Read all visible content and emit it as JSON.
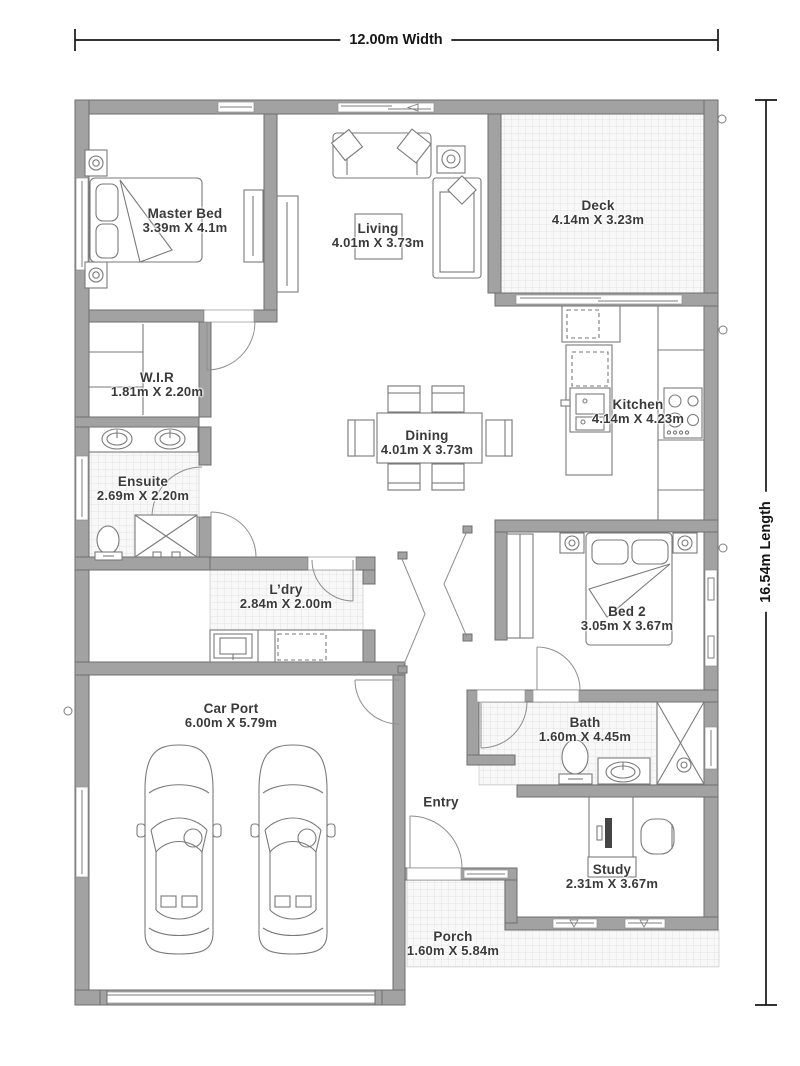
{
  "plan": {
    "width_label": "12.00m Width",
    "length_label": "16.54m Length"
  },
  "rooms": [
    {
      "name": "Master Bed",
      "size": "3.39m X 4.1m"
    },
    {
      "name": "Living",
      "size": "4.01m X 3.73m"
    },
    {
      "name": "Deck",
      "size": "4.14m X 3.23m"
    },
    {
      "name": "W.I.R",
      "size": "1.81m X 2.20m"
    },
    {
      "name": "Ensuite",
      "size": "2.69m X 2.20m"
    },
    {
      "name": "Kitchen",
      "size": "4.14m X 4.23m"
    },
    {
      "name": "Dining",
      "size": "4.01m X 3.73m"
    },
    {
      "name": "L’dry",
      "size": "2.84m X 2.00m"
    },
    {
      "name": "Bed 2",
      "size": "3.05m X 3.67m"
    },
    {
      "name": "Car Port",
      "size": "6.00m X 5.79m"
    },
    {
      "name": "Bath",
      "size": "1.60m X 4.45m"
    },
    {
      "name": "Entry",
      "size": ""
    },
    {
      "name": "Study",
      "size": "2.31m X 3.67m"
    },
    {
      "name": "Porch",
      "size": "1.60m X 5.84m"
    }
  ],
  "colors": {
    "wall": "#a2a2a2",
    "wall_outline": "#6e6e6e",
    "furniture_line": "#7a7a7a",
    "tile_line": "#d8d8d8",
    "text": "#3a3a3a",
    "dimension_line": "#161616",
    "background": "#ffffff"
  }
}
